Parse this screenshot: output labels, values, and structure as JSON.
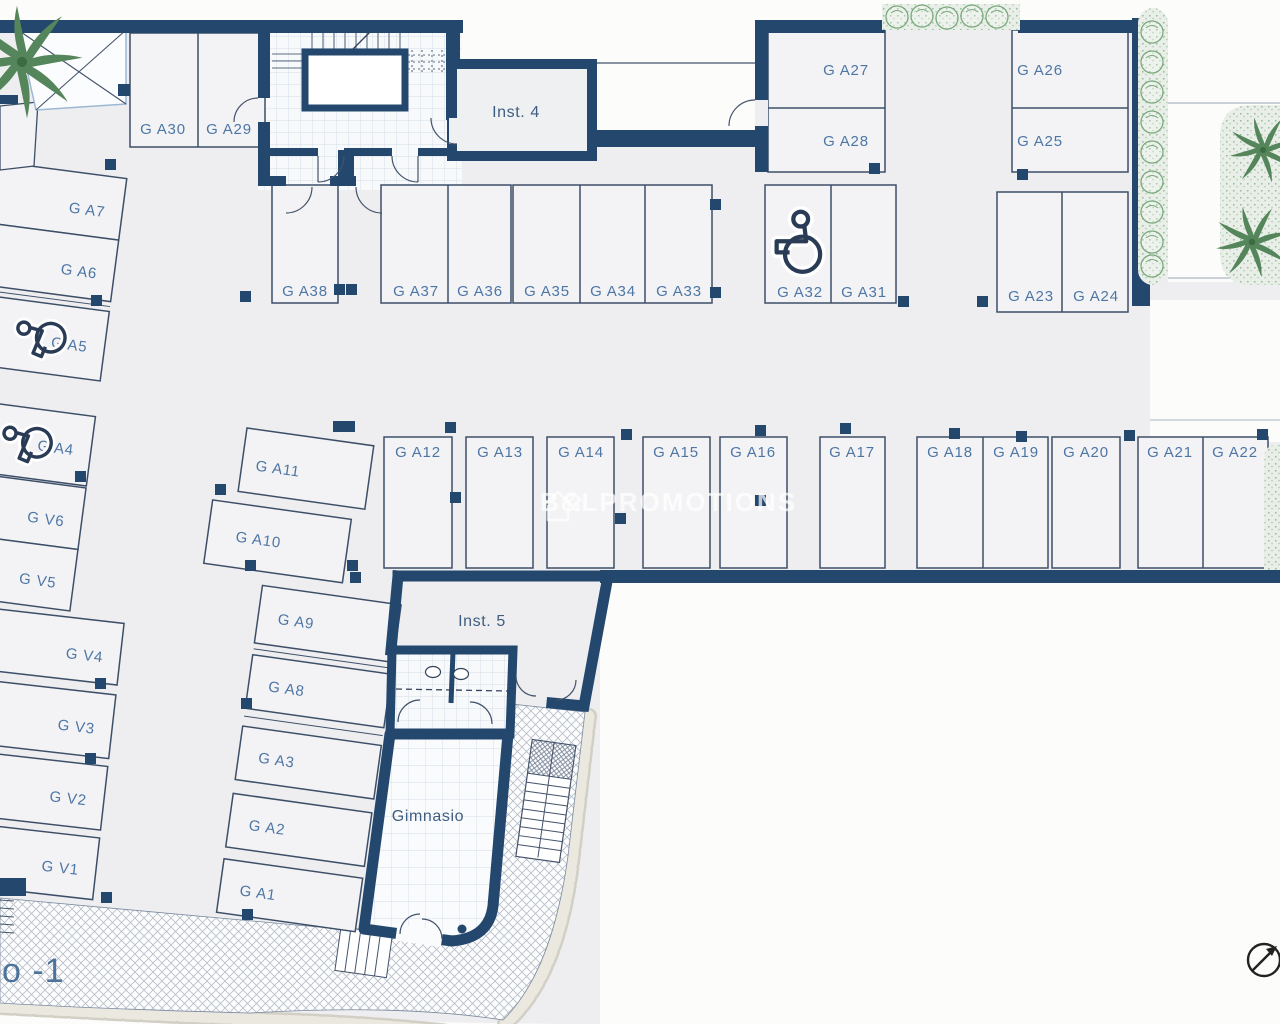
{
  "meta": {
    "floor_label": "o -1",
    "watermark_text": "B&LPROMOTIONS"
  },
  "rooms": {
    "inst4": "Inst. 4",
    "inst5": "Inst. 5",
    "gym": "Gimnasio"
  },
  "spaces": {
    "a1": "G A1",
    "a2": "G A2",
    "a3": "G A3",
    "a4": "G A4",
    "a5": "G A5",
    "a6": "G A6",
    "a7": "G A7",
    "a8": "G A8",
    "a9": "G A9",
    "a10": "G A10",
    "a11": "G A11",
    "a12": "G A12",
    "a13": "G A13",
    "a14": "G A14",
    "a15": "G A15",
    "a16": "G A16",
    "a17": "G A17",
    "a18": "G A18",
    "a19": "G A19",
    "a20": "G A20",
    "a21": "G A21",
    "a22": "G A22",
    "a23": "G A23",
    "a24": "G A24",
    "a25": "G A25",
    "a26": "G A26",
    "a27": "G A27",
    "a28": "G A28",
    "a29": "G A29",
    "a30": "G A30",
    "a31": "G A31",
    "a32": "G A32",
    "a33": "G A33",
    "a34": "G A34",
    "a35": "G A35",
    "a36": "G A36",
    "a37": "G A37",
    "a38": "G A38",
    "v1": "G V1",
    "v2": "G V2",
    "v3": "G V3",
    "v4": "G V4",
    "v5": "G V5",
    "v6": "G V6"
  },
  "icons": {
    "wheelchair_icon": "accessible-parking",
    "compass_icon": "north-arrow",
    "house_icon": "brand-house-logo",
    "palm_icon": "palm-tree",
    "bush_icon": "shrub"
  },
  "colors": {
    "wall": "#24476e",
    "label": "#4d76a5",
    "green": "#6fa173",
    "stone": "#e8e5dd",
    "background": "#eeeef0"
  }
}
